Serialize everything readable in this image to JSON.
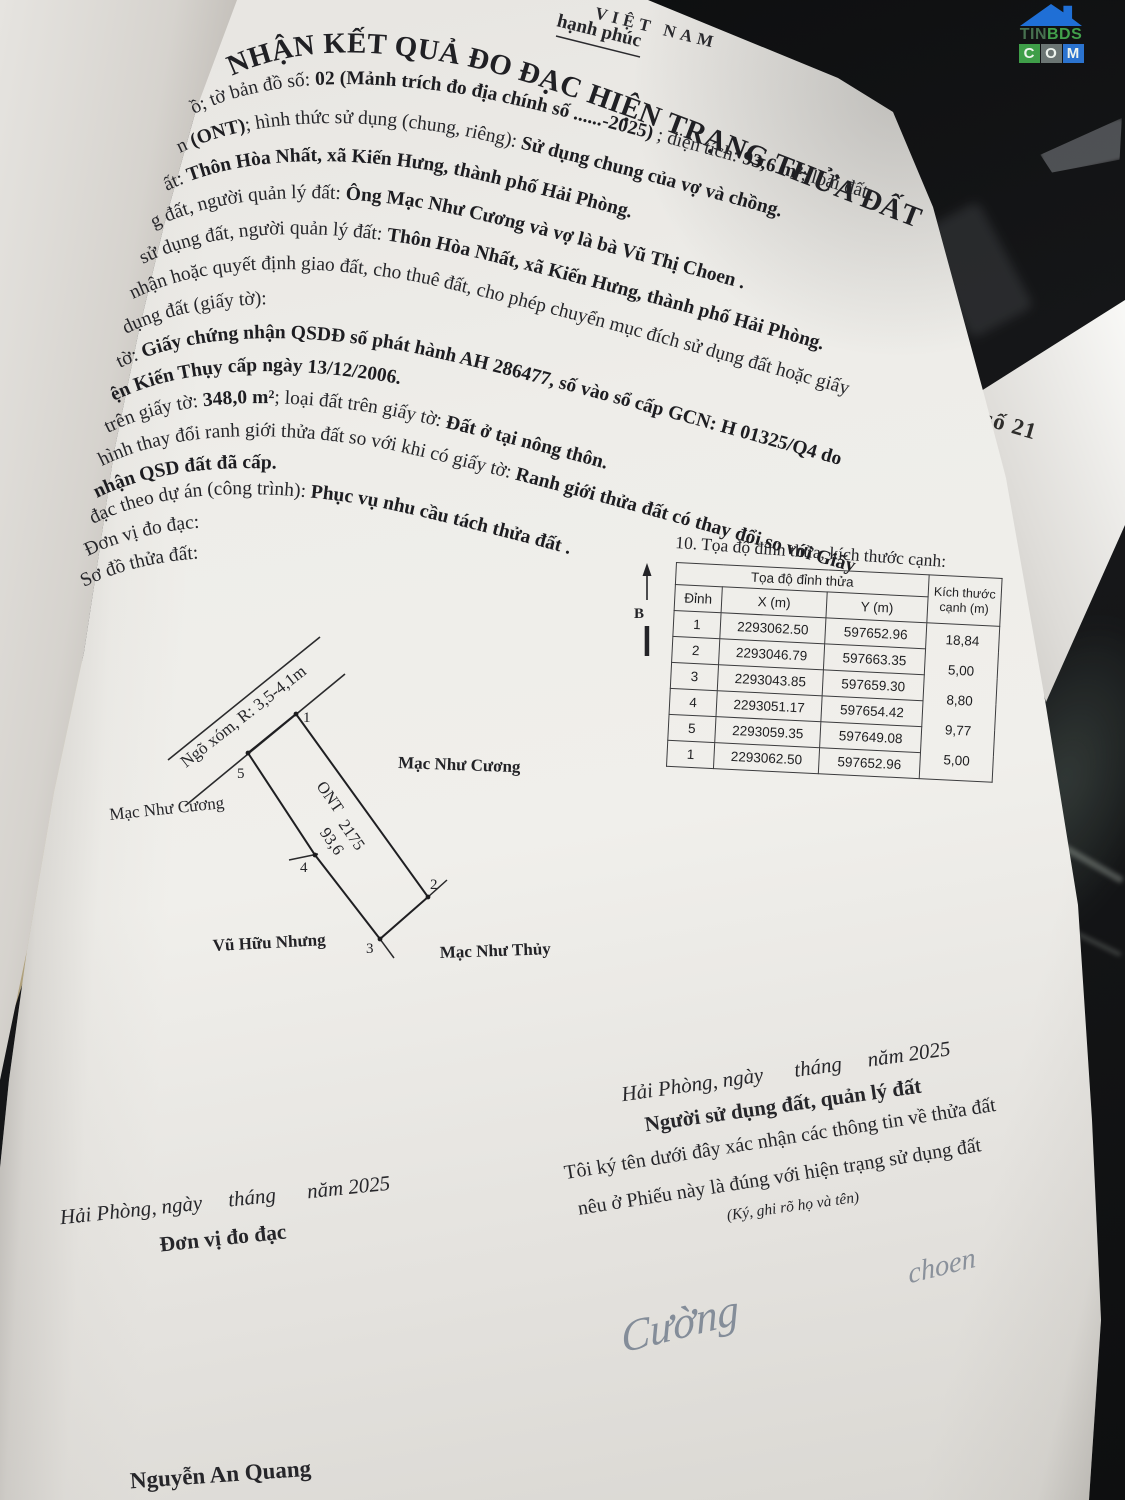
{
  "logo": {
    "tin": "TIN",
    "bds": "BDS",
    "c": "C",
    "o": "O",
    "m": "M"
  },
  "background_sheet": {
    "label": "ếu số 21"
  },
  "document": {
    "national_fragment": "VIỆT NAM",
    "motto_fragment": "hạnh phúc",
    "title": "NHẬN KẾT QUẢ ĐO ĐẠC HIỆN TRẠNG THỬA ĐẤT",
    "body_lines": [
      {
        "segments": [
          {
            "t": "ồ; tờ bản đồ số: ",
            "b": false
          },
          {
            "t": "02 (Mảnh trích đo địa chính số ......-2025)",
            "b": true
          },
          {
            "t": " ; diện tích: ",
            "b": false
          },
          {
            "t": "93,6 m²",
            "b": true
          },
          {
            "t": "; loại đất:",
            "b": false
          }
        ]
      },
      {
        "segments": [
          {
            "t": "n ",
            "b": false
          },
          {
            "t": "(ONT)",
            "b": true
          },
          {
            "t": "; hình thức sử dụng (chung, riêng): ",
            "b": false
          },
          {
            "t": "Sử dụng chung của vợ và chồng.",
            "b": true
          }
        ]
      },
      {
        "segments": [
          {
            "t": "ất: ",
            "b": false
          },
          {
            "t": "Thôn Hòa Nhất, xã Kiến Hưng, thành phố Hải Phòng.",
            "b": true
          }
        ]
      },
      {
        "segments": [
          {
            "t": "g đất, người quản lý đất: ",
            "b": false
          },
          {
            "t": "Ông Mạc Như Cương và vợ là bà Vũ Thị Choen .",
            "b": true
          }
        ]
      },
      {
        "segments": [
          {
            "t": "sử dụng đất, người quản lý đất: ",
            "b": false
          },
          {
            "t": "Thôn Hòa Nhất, xã Kiến Hưng, thành phố Hải Phòng.",
            "b": true
          }
        ]
      },
      {
        "segments": [
          {
            "t": "nhận hoặc quyết định giao đất, cho thuê đất, cho phép chuyển mục đích sử dụng đất hoặc giấy",
            "b": false
          }
        ]
      },
      {
        "segments": [
          {
            "t": "dụng đất (giấy tờ):",
            "b": false
          }
        ]
      },
      {
        "segments": [
          {
            "t": "tờ: ",
            "b": false
          },
          {
            "t": "Giấy chứng nhận QSDĐ số phát hành AH 286477, số vào sổ cấp GCN: H 01325/Q4 do",
            "b": true
          }
        ]
      },
      {
        "segments": [
          {
            "t": "ện Kiến Thụy cấp ngày 13/12/2006.",
            "b": true
          }
        ]
      },
      {
        "segments": [
          {
            "t": "trên giấy tờ: ",
            "b": false
          },
          {
            "t": "348,0 m²",
            "b": true
          },
          {
            "t": "; loại đất trên giấy tờ: ",
            "b": false
          },
          {
            "t": "Đất ở tại nông thôn.",
            "b": true
          }
        ]
      },
      {
        "segments": [
          {
            "t": "hình thay đổi ranh giới thửa đất so với khi có giấy tờ: ",
            "b": false
          },
          {
            "t": "Ranh giới thửa đất có thay đổi so với Giấy",
            "b": true
          }
        ]
      },
      {
        "segments": [
          {
            "t": "nhận QSD đất đã cấp.",
            "b": true
          }
        ]
      },
      {
        "segments": [
          {
            "t": "đạc theo dự án (công trình): ",
            "b": false
          },
          {
            "t": "Phục vụ nhu cầu tách thửa đất .",
            "b": true
          }
        ]
      },
      {
        "segments": [
          {
            "t": "Đơn vị đo đạc:",
            "b": false
          }
        ]
      },
      {
        "segments": [
          {
            "t": "Sơ đồ thửa đất:",
            "b": false
          }
        ]
      }
    ]
  },
  "section10": {
    "caption": "10. Tọa độ đỉnh thửa, kích thước cạnh:",
    "north_label": "B",
    "table": {
      "group_header": "Tọa độ đỉnh thửa",
      "col_vertex": "Đỉnh",
      "col_x": "X (m)",
      "col_y": "Y (m)",
      "col_edge": "Kích thước cạnh (m)",
      "rows": [
        {
          "v": "1",
          "x": "2293062.50",
          "y": "597652.96"
        },
        {
          "v": "2",
          "x": "2293046.79",
          "y": "597663.35"
        },
        {
          "v": "3",
          "x": "2293043.85",
          "y": "597659.30"
        },
        {
          "v": "4",
          "x": "2293051.17",
          "y": "597654.42"
        },
        {
          "v": "5",
          "x": "2293059.35",
          "y": "597649.08"
        },
        {
          "v": "1",
          "x": "2293062.50",
          "y": "597652.96"
        }
      ],
      "edge_lengths": [
        "18,84",
        "5,00",
        "8,80",
        "9,77",
        "5,00"
      ]
    }
  },
  "diagram": {
    "road_label": "Ngõ xóm, R: 3,5-4,1m",
    "parcel_code": "ONT",
    "parcel_number": "2175",
    "parcel_area": "93,6",
    "neighbor_right": "Mạc Như Cương",
    "neighbor_left": "Mạc Như Cương",
    "neighbor_bottom_left": "Vũ Hữu Nhưng",
    "neighbor_bottom_right": "Mạc Như Thủy",
    "vertex_labels": [
      "1",
      "2",
      "3",
      "4",
      "5"
    ]
  },
  "signature_right": {
    "date_line": "Hải Phòng, ngày      tháng     năm 2025",
    "role": "Người sử dụng đất, quản lý đất",
    "statement1": "Tôi ký tên dưới đây xác nhận các thông tin về thửa đất",
    "statement2": "nêu ở Phiếu này là đúng với hiện trạng sử dụng đất",
    "note": "(Ký, ghi rõ họ và tên)",
    "signature1": "Cường",
    "signature2": "choen"
  },
  "signature_left": {
    "date_line": "Hải Phòng, ngày     tháng      năm 2025",
    "role": "Đơn vị đo đạc",
    "name": "Nguyễn An Quang"
  }
}
